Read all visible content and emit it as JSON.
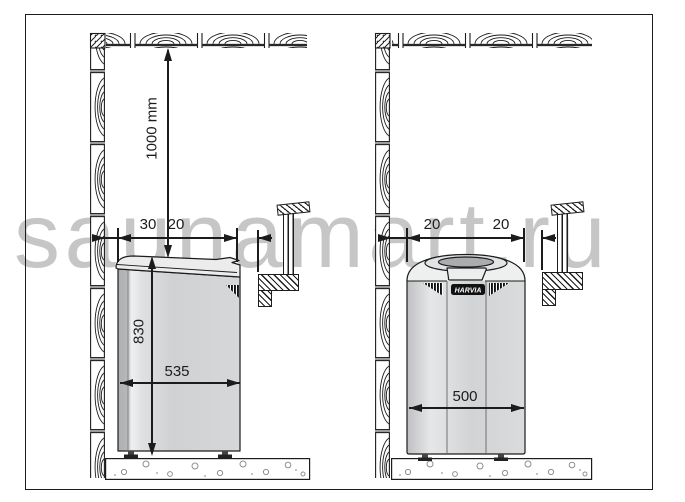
{
  "watermark": {
    "text": "saunamart.ru",
    "color": "#c6c6c6"
  },
  "left_diagram": {
    "dimensions": {
      "ceiling_clearance": "1000 mm",
      "wall_clearance": "30",
      "bench_clearance": "20",
      "heater_height": "830",
      "heater_width": "535"
    }
  },
  "right_diagram": {
    "dimensions": {
      "wall_clearance": "20",
      "bench_clearance": "20",
      "heater_width": "500"
    },
    "heater_brand": "HARVIA"
  },
  "colors": {
    "line": "#1c1c1c",
    "heater_body": "#d3d4d6",
    "heater_lid": "#ececed",
    "wall_gap": "#9a9a9a",
    "watermark": "#c6c6c6",
    "logo_bg": "#111111"
  }
}
